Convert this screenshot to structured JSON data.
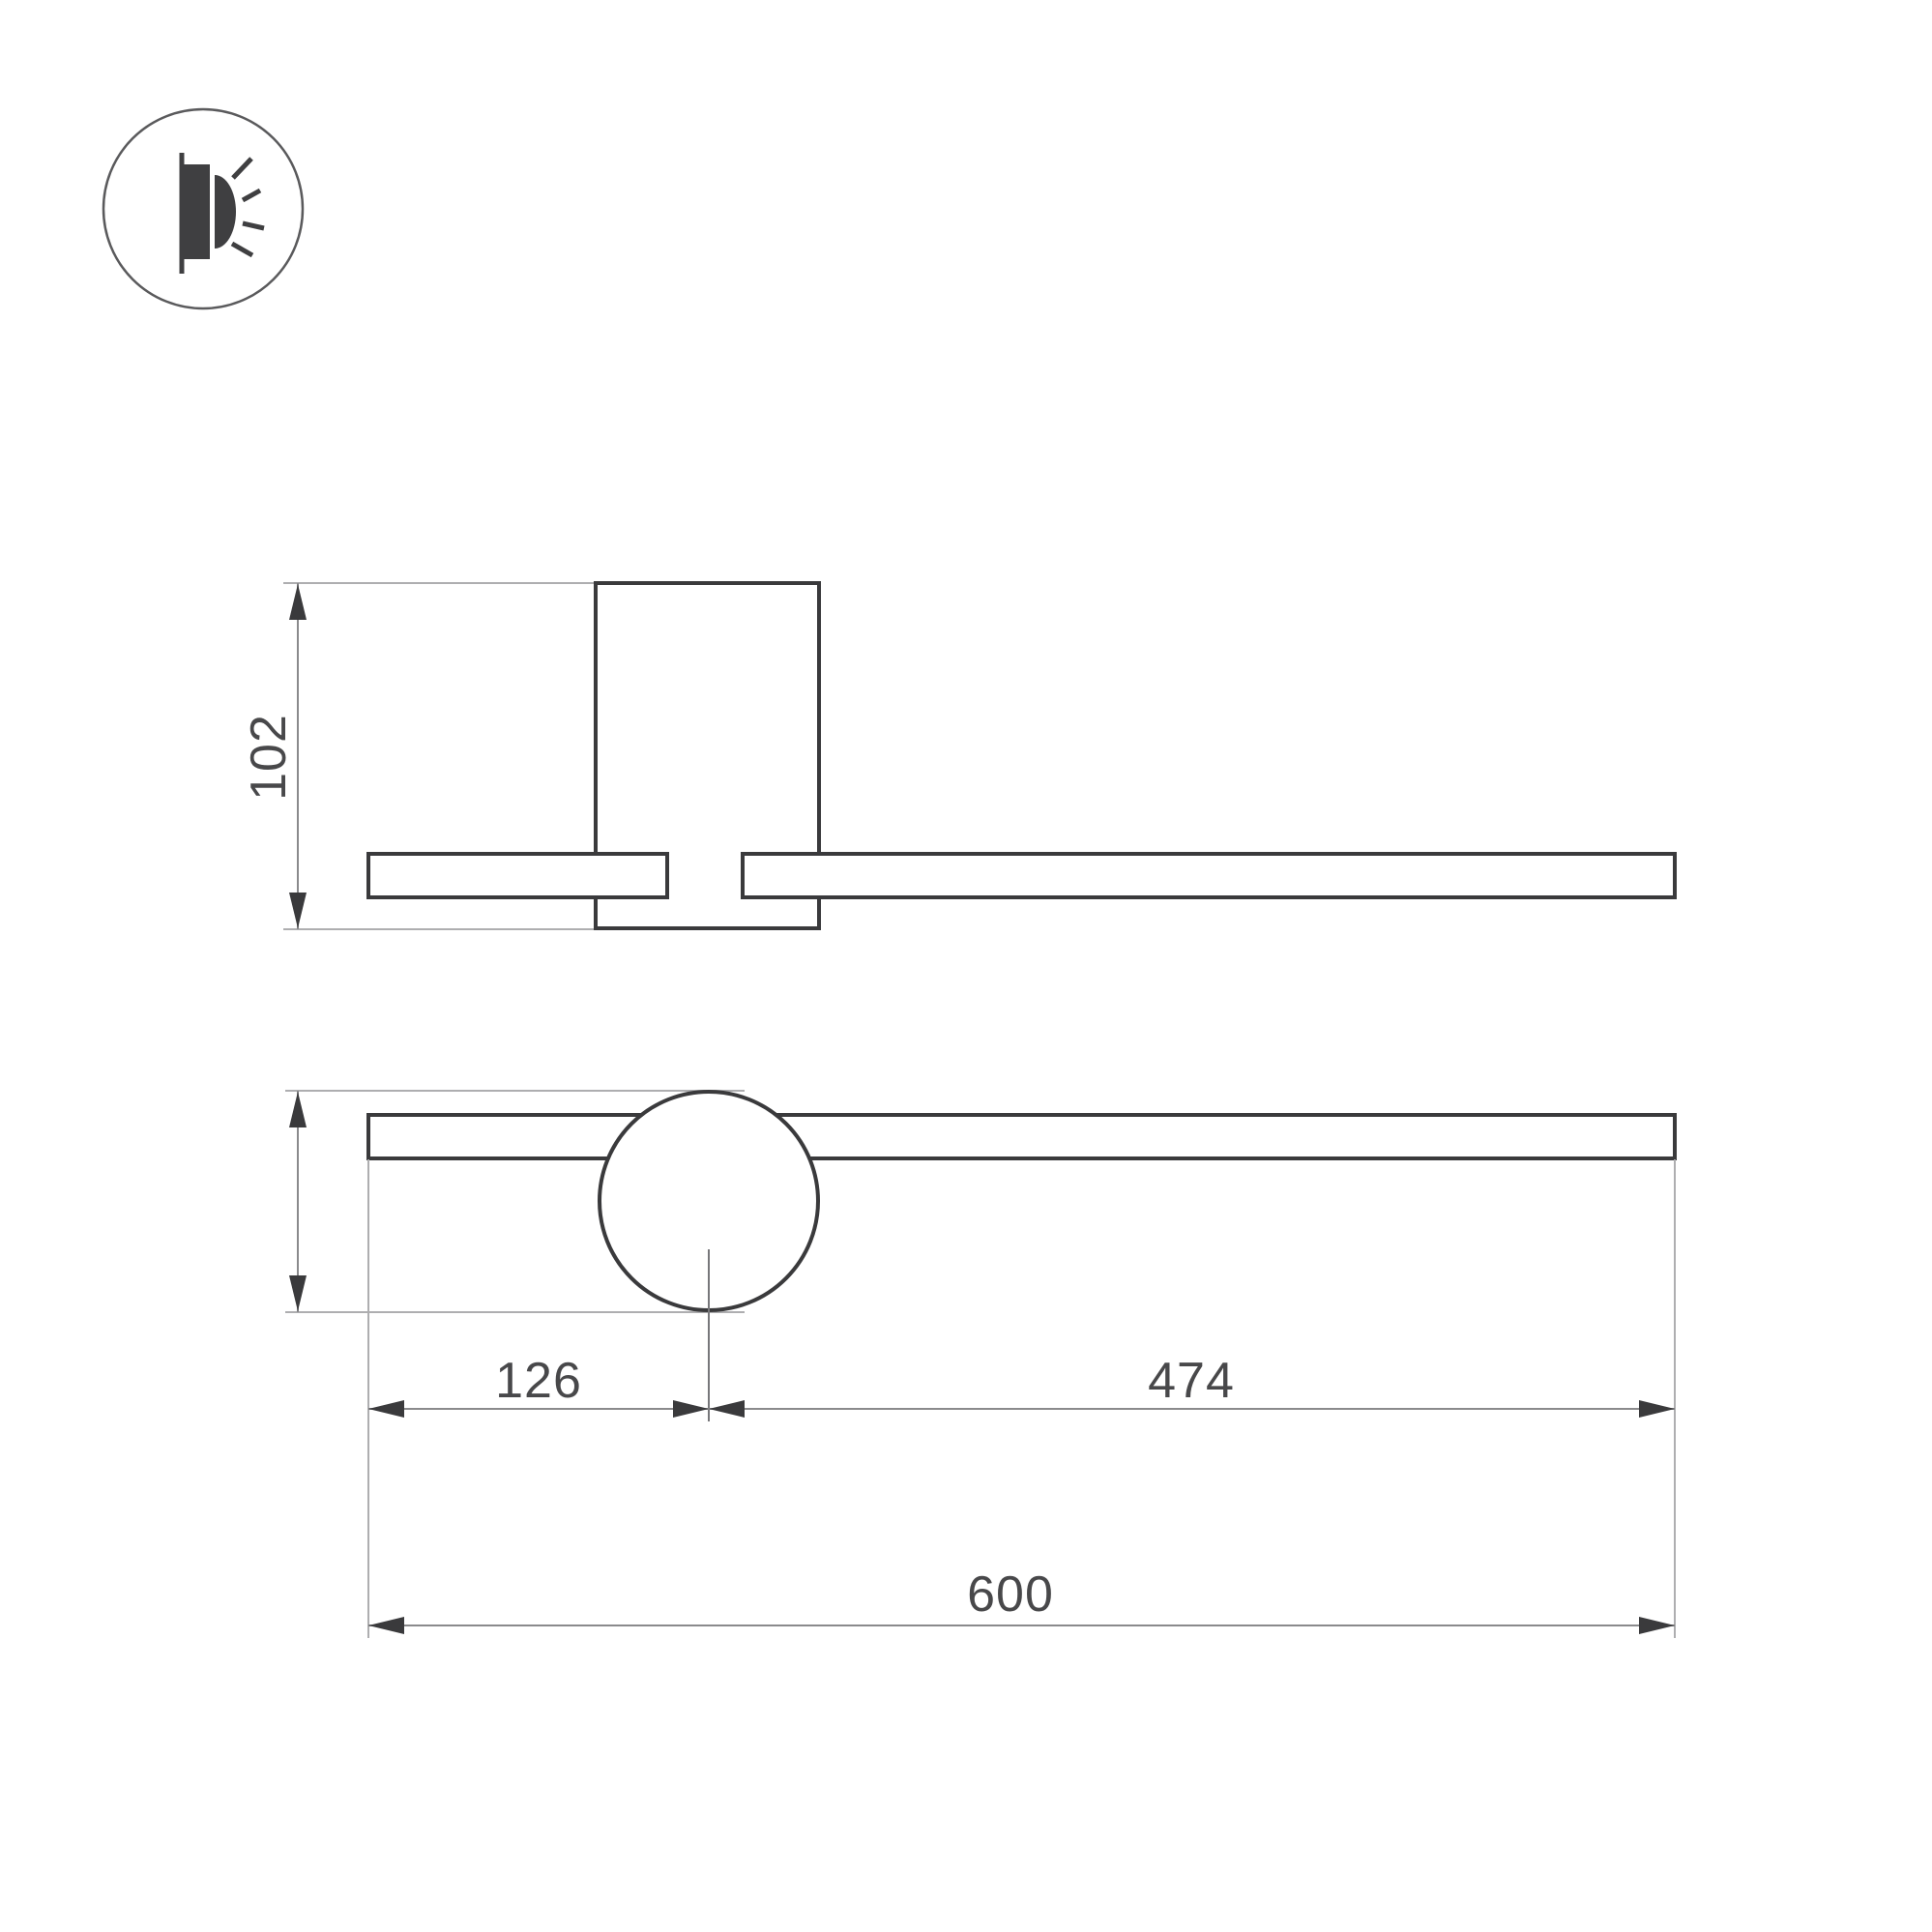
{
  "icon": {
    "name": "surface-wall-light-emission-icon"
  },
  "drawing": {
    "type": "dimensioned-technical-drawing",
    "dimensions": {
      "depth": "102",
      "height": "50",
      "offset_left": "126",
      "offset_right": "474",
      "length": "600"
    }
  },
  "colors": {
    "outline": "#3a3a3c",
    "ext-line": "#aeaeb0",
    "dim-line": "#8a8a8c",
    "center-line": "#77777a",
    "arrow": "#3a3a3c",
    "text": "#48484a",
    "icon-dark": "#3f3f41",
    "icon-ring": "#5a5a5c",
    "background": "#ffffff"
  }
}
